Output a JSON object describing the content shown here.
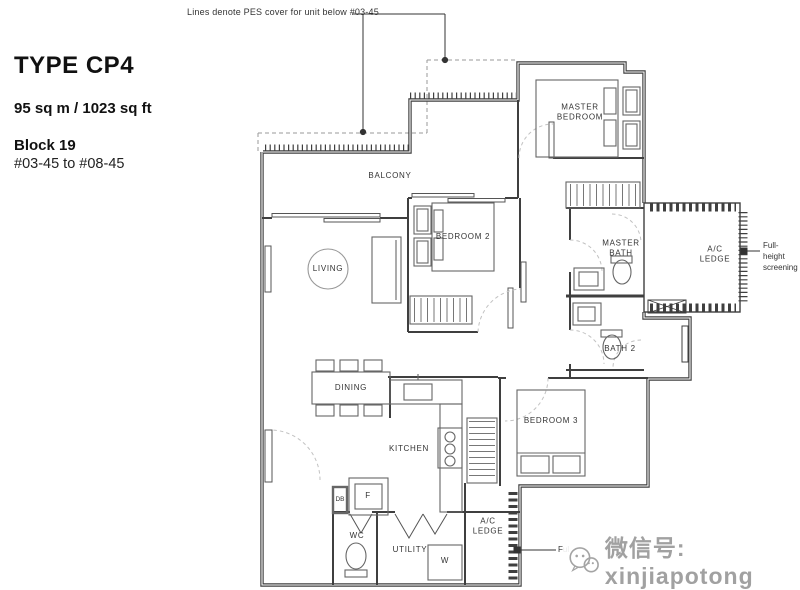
{
  "header": {
    "title": "TYPE CP4",
    "area": "95 sq m / 1023 sq ft",
    "block": "Block 19",
    "unit_range": "#03-45 to #08-45"
  },
  "annotations": {
    "pes_note": "Lines denote PES cover for unit below #03-45",
    "full_height_screening_right": "Full-height\nscreening",
    "full_height_screening_bottom": "Full-height screening"
  },
  "rooms": {
    "balcony": "BALCONY",
    "living": "LIVING",
    "dining": "DINING",
    "kitchen": "KITCHEN",
    "bedroom2": "BEDROOM 2",
    "bedroom3": "BEDROOM 3",
    "master_bedroom": "MASTER\nBEDROOM",
    "master_bath": "MASTER\nBATH",
    "bath2": "BATH 2",
    "wc": "WC",
    "utility": "UTILITY",
    "ac_ledge_right": "A/C\nLEDGE",
    "ac_ledge_bottom": "A/C\nLEDGE"
  },
  "fixtures": {
    "db": "DB",
    "fridge": "F",
    "washer": "W"
  },
  "watermark": {
    "text": "微信号: xinjiapotong"
  },
  "colors": {
    "wall": "#3f3f3f",
    "furniture": "#666666",
    "dashed_arc": "#c2c2c2",
    "watermark": "#9c9c9c"
  }
}
